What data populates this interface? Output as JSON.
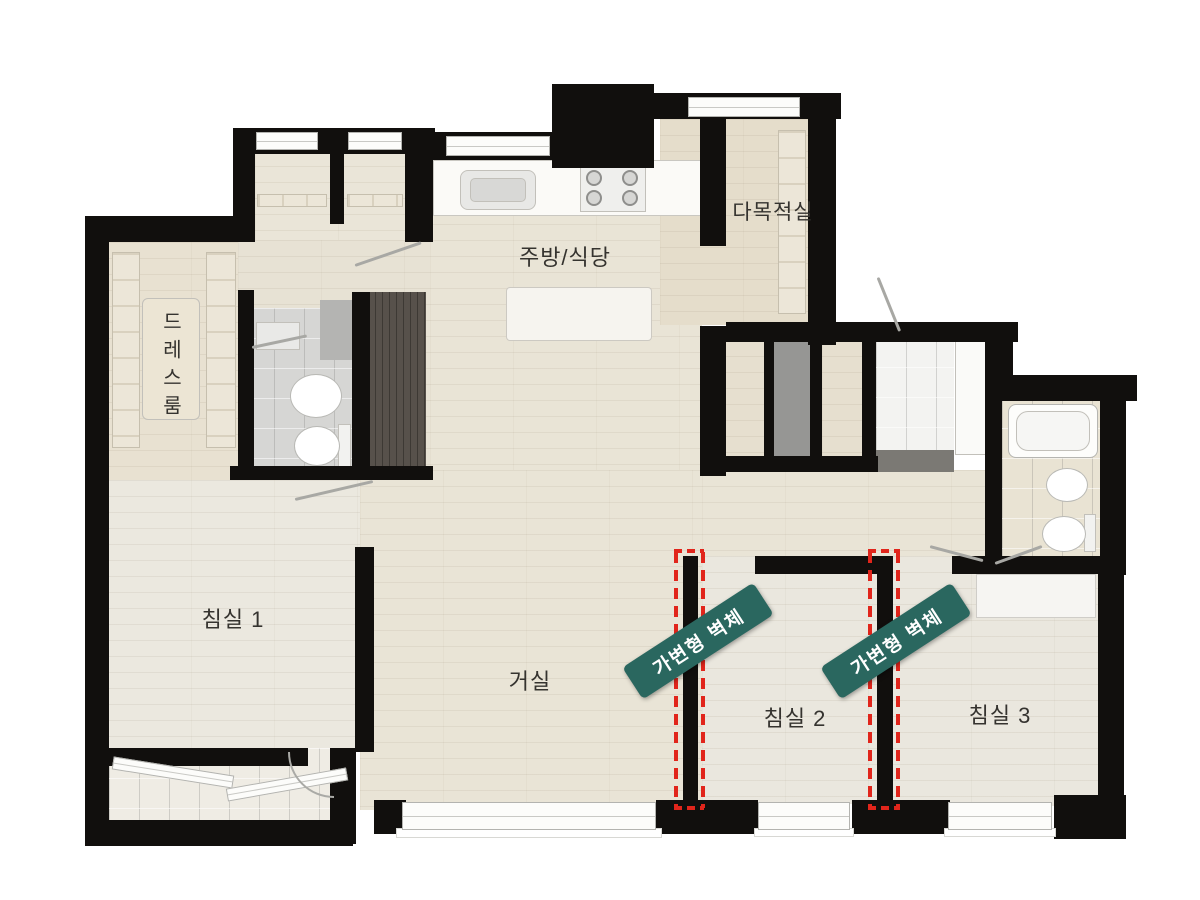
{
  "colors": {
    "wall": "#110f0d",
    "floor_main": "#e9e4d6",
    "floor_warm": "#e5ddcb",
    "tile_gray": "#d6d6d4",
    "wood_dark": "#57514b",
    "window_fill": "#fcfcfa",
    "badge_bg": "#2a675f",
    "badge_text": "#ffffff",
    "movable_wall_red": "#e1251b",
    "background": "#ffffff"
  },
  "rooms": {
    "kitchen_dining": {
      "label": "주방/식당"
    },
    "multipurpose": {
      "label": "다목적실"
    },
    "dressroom": {
      "label": "드레스룸"
    },
    "bedroom1": {
      "label": "침실 1"
    },
    "living": {
      "label": "거실"
    },
    "bedroom2": {
      "label": "침실 2"
    },
    "bedroom3": {
      "label": "침실 3"
    }
  },
  "annotations": {
    "movable_wall_badge_1": {
      "label": "가변형 벽체"
    },
    "movable_wall_badge_2": {
      "label": "가변형 벽체"
    }
  }
}
